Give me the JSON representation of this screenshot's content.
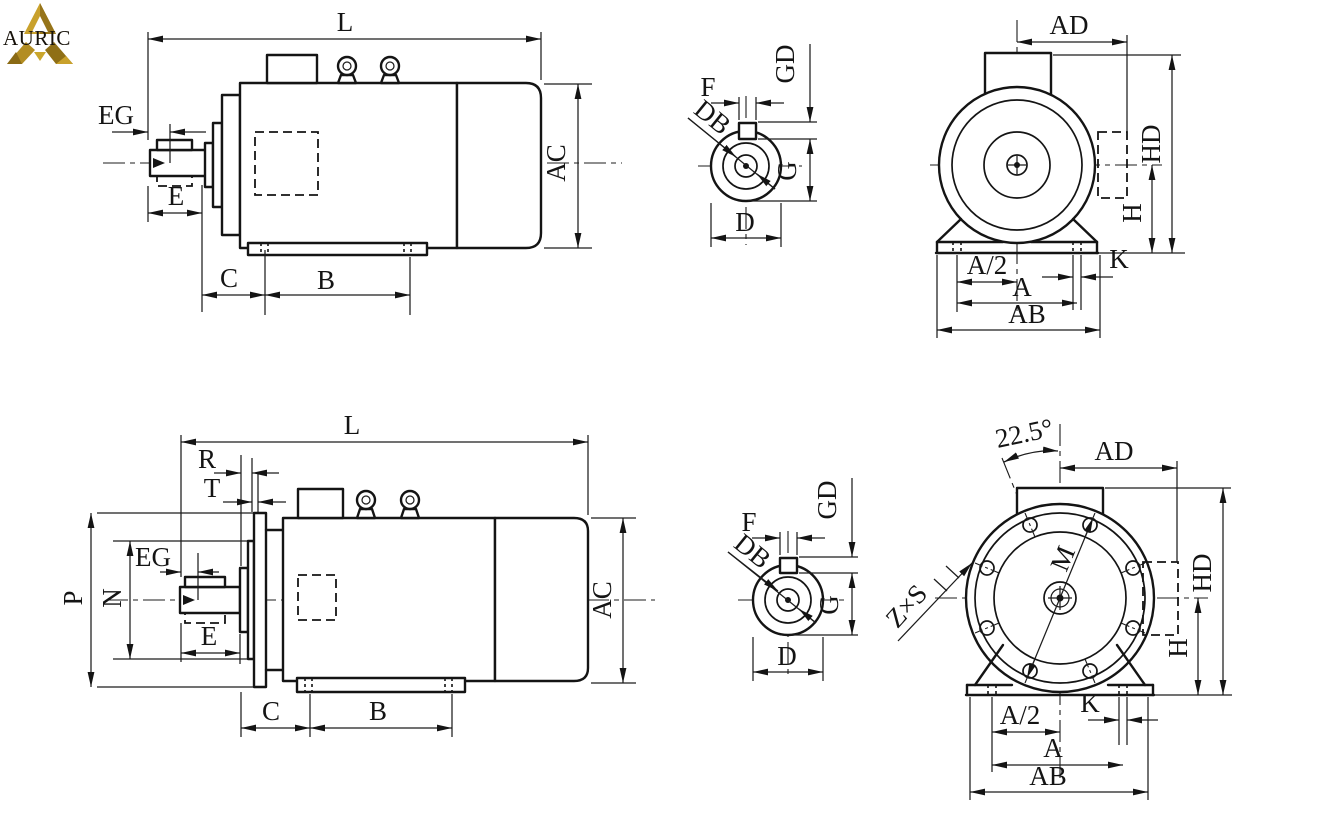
{
  "brand": {
    "name": "AURIC"
  },
  "views": {
    "side_foot": {
      "L": "L",
      "EG": "EG",
      "E": "E",
      "AC": "AC",
      "C": "C",
      "B": "B"
    },
    "shaft_end_top": {
      "F": "F",
      "GD": "GD",
      "DB": "DB",
      "G": "G",
      "D": "D"
    },
    "front_foot": {
      "AD": "AD",
      "HD": "HD",
      "H": "H",
      "A_half": "A/2",
      "K": "K",
      "A": "A",
      "AB": "AB"
    },
    "side_flange": {
      "L": "L",
      "R": "R",
      "T": "T",
      "EG": "EG",
      "E": "E",
      "P": "P",
      "N": "N",
      "AC": "AC",
      "C": "C",
      "B": "B"
    },
    "shaft_end_bottom": {
      "F": "F",
      "GD": "GD",
      "DB": "DB",
      "G": "G",
      "D": "D"
    },
    "front_flange": {
      "angle": "22.5°",
      "AD": "AD",
      "HD": "HD",
      "H": "H",
      "M": "M",
      "ZxS": "Z×S",
      "A_half": "A/2",
      "K": "K",
      "A": "A",
      "AB": "AB"
    }
  }
}
